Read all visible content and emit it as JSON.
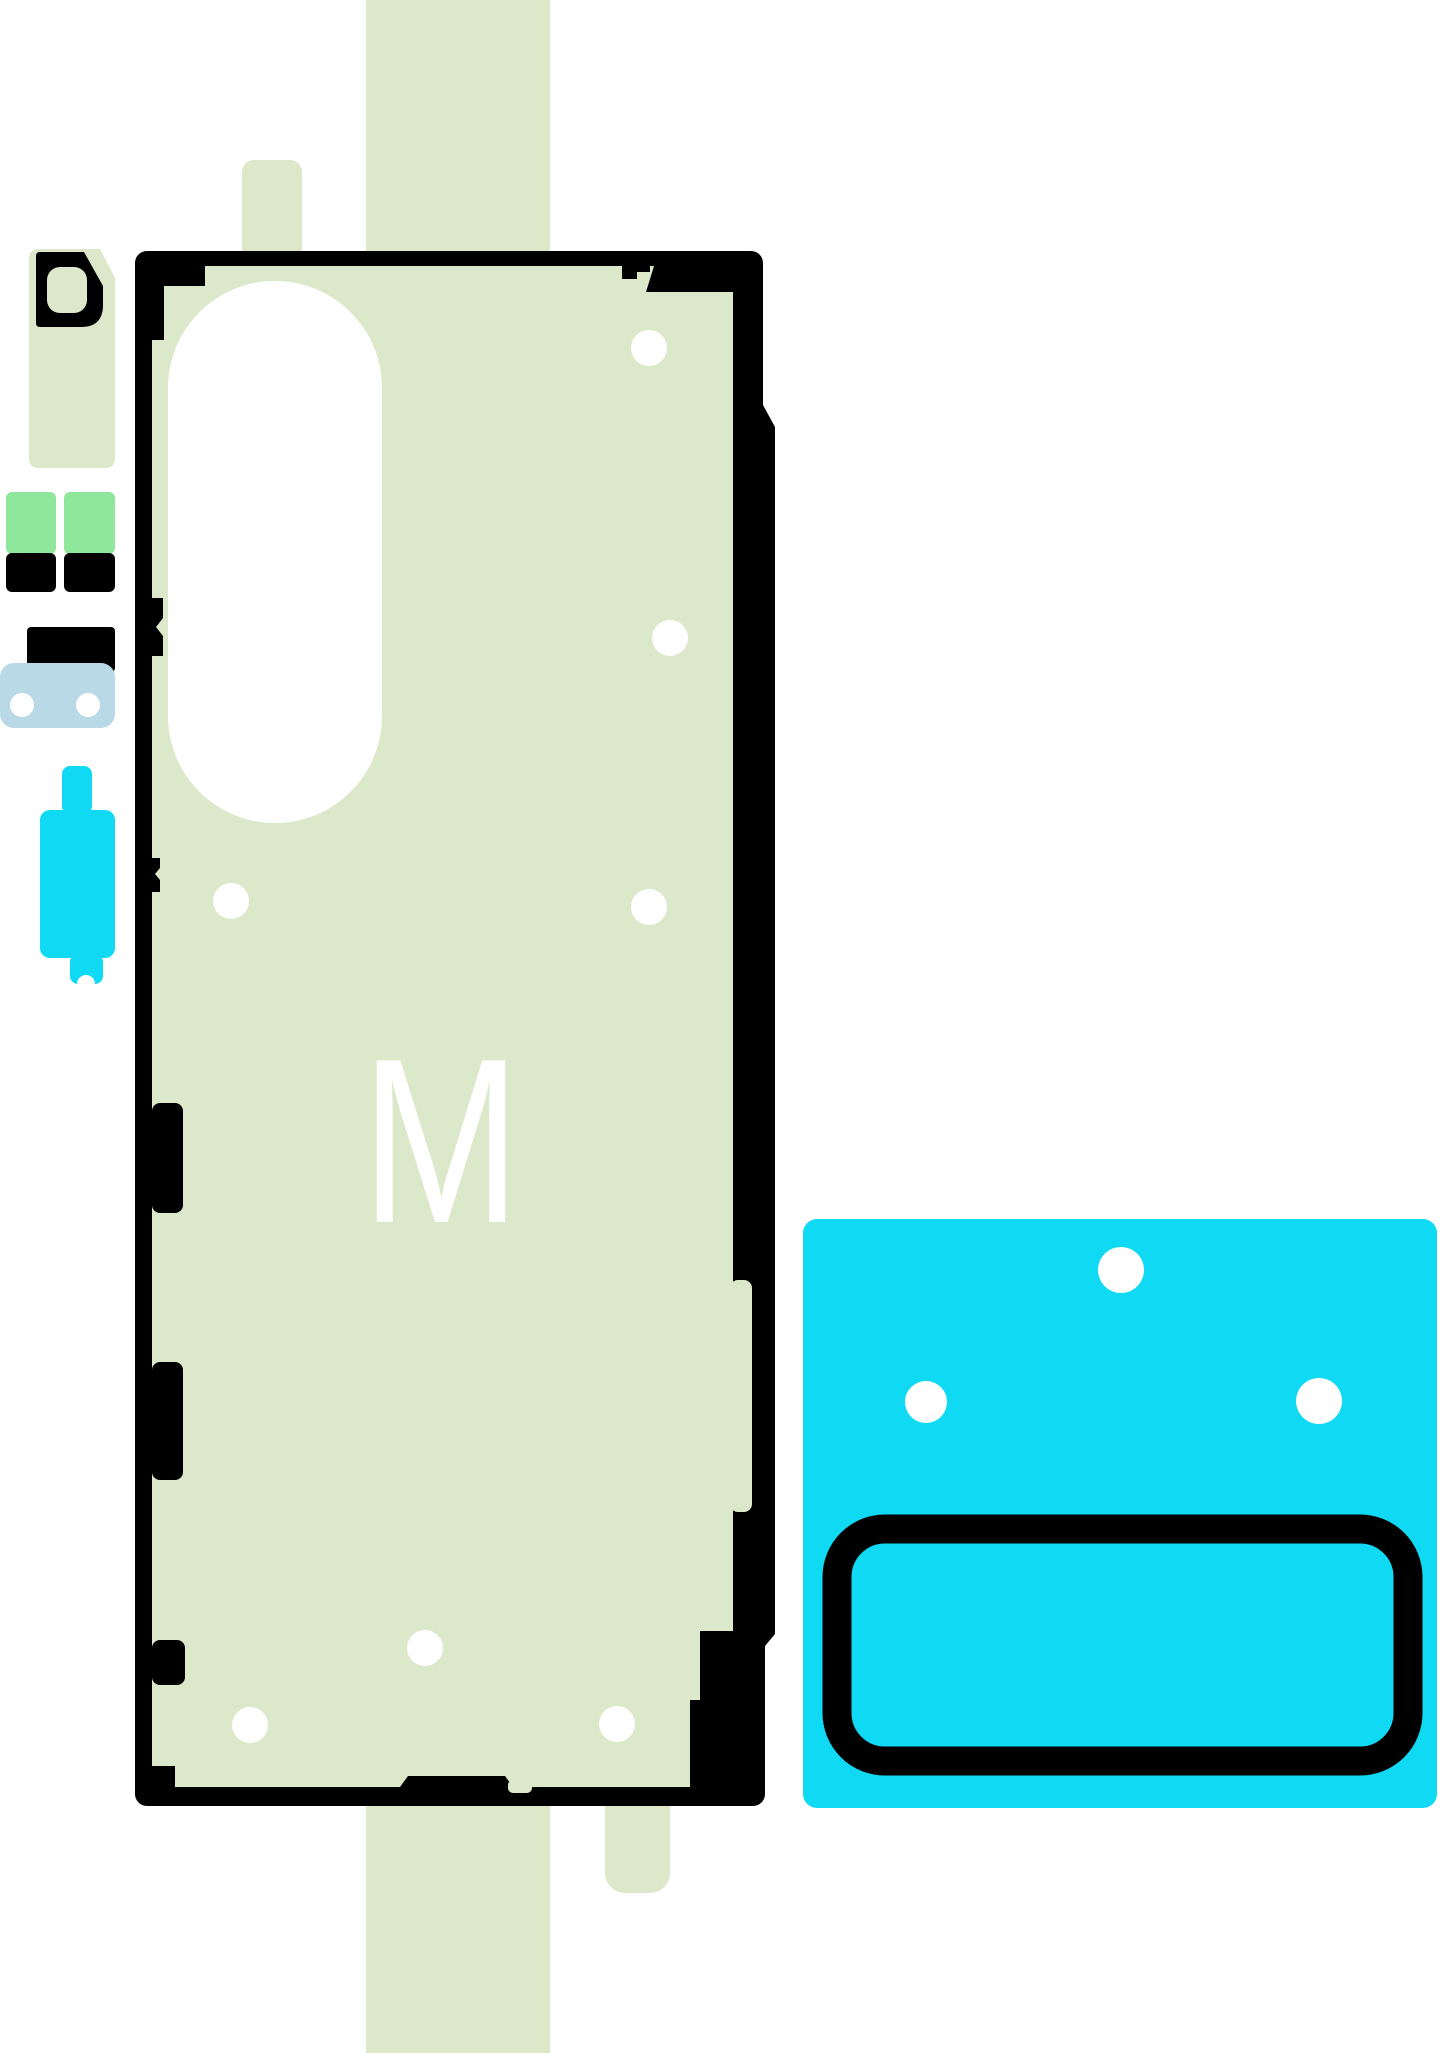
{
  "main_adhesive": {
    "label": "M"
  },
  "colors": {
    "background": "#ffffff",
    "liner_green": "#dde8cb",
    "adhesive_green": "#dce8ca",
    "bright_green": "#8fe79b",
    "light_blue": "#b9d9e7",
    "cyan": "#10d9f4",
    "ink": "#000000",
    "white": "#ffffff"
  }
}
